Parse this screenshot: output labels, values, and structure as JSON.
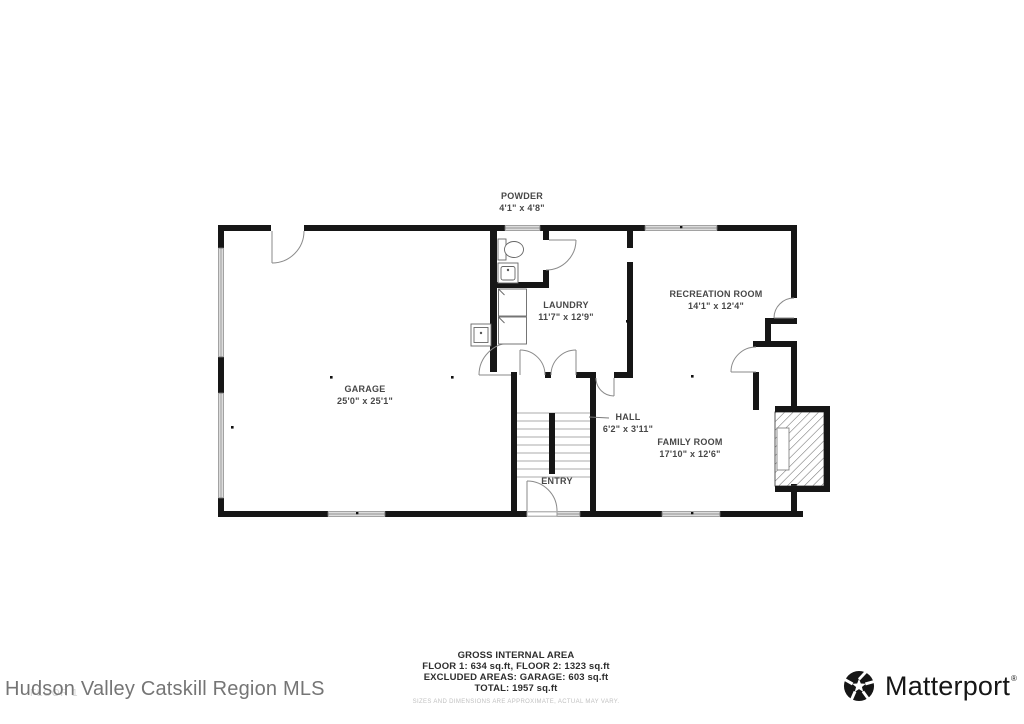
{
  "floor_label": "FLOOR 1",
  "rooms": [
    {
      "name": "POWDER",
      "dims": "4'1\" x 4'8\""
    },
    {
      "name": "LAUNDRY",
      "dims": "11'7\" x 12'9\""
    },
    {
      "name": "RECREATION ROOM",
      "dims": "14'1\" x 12'4\""
    },
    {
      "name": "GARAGE",
      "dims": "25'0\" x 25'1\""
    },
    {
      "name": "HALL",
      "dims": "6'2\" x 3'11\""
    },
    {
      "name": "FAMILY ROOM",
      "dims": "17'10\" x 12'6\""
    },
    {
      "name": "ENTRY",
      "dims": ""
    }
  ],
  "footer": {
    "title": "GROSS INTERNAL AREA",
    "line1": "FLOOR 1: 634 sq.ft, FLOOR 2: 1323 sq.ft",
    "line2": "EXCLUDED AREAS: GARAGE: 603 sq.ft",
    "line3": "TOTAL: 1957 sq.ft",
    "disclaimer": "SIZES AND DIMENSIONS ARE APPROXIMATE, ACTUAL MAY VARY."
  },
  "branding": {
    "mls": "Hudson Valley Catskill Region MLS",
    "logo_text": "Matterport",
    "trademark": "®"
  },
  "colors": {
    "wall": "#161616",
    "label": "#474747",
    "watermark": "#d3d3d3",
    "mls_text": "#757575"
  }
}
